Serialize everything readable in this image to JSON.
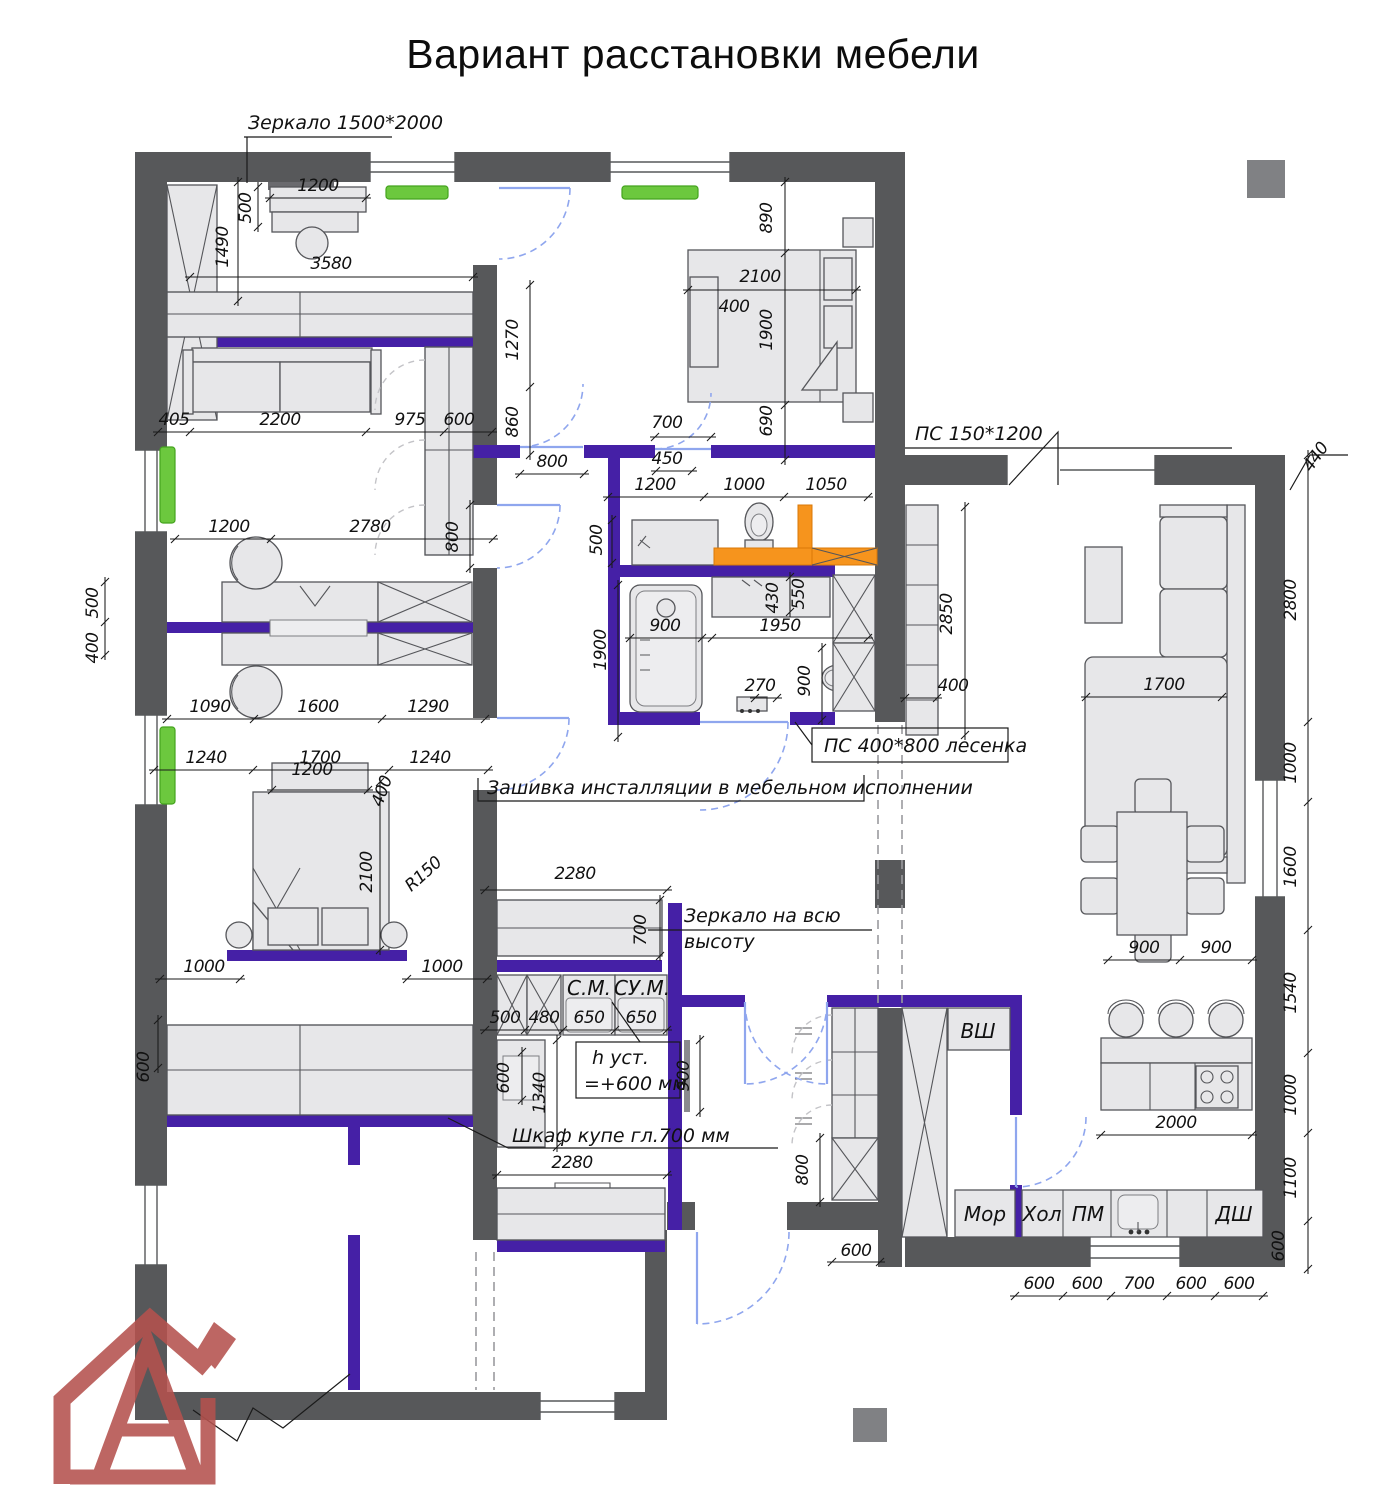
{
  "title": "Вариант расстановки мебели",
  "colors": {
    "wall_gray": "#57585a",
    "accent_purple": "#4520a6",
    "radiator_green": "#6cc83e",
    "installation_orange": "#f6941d",
    "door_blue": "#8fa6ee",
    "logo_red": "#b5524e"
  },
  "annotations": {
    "mirror_top": "Зеркало  1500*2000",
    "ps_window": "ПС  150*1200",
    "ps_ladder": "ПС  400*800  лесенка",
    "installation": "Зашивка инсталляции в мебельном исполнении",
    "mirror_full_1": "Зеркало на всю",
    "mirror_full_2": "высоту",
    "wardrobe": "Шкаф купе гл.700 мм",
    "h_inst_1": "h  уст.",
    "h_inst_2": "=+600 мм"
  },
  "labels": {
    "vsh": "ВШ",
    "mor": "Мор",
    "hol": "Хол",
    "pm": "ПМ",
    "dsh": "ДШ",
    "sm": "С.М.",
    "sum": "СУ.М."
  },
  "dims": [
    {
      "t": "1200",
      "x": 318,
      "y": 191
    },
    {
      "t": "500",
      "x": 251,
      "y": 208,
      "r": -90
    },
    {
      "t": "1490",
      "x": 228,
      "y": 247,
      "r": -90
    },
    {
      "t": "3580",
      "x": 331,
      "y": 269
    },
    {
      "t": "405",
      "x": 174,
      "y": 425
    },
    {
      "t": "2200",
      "x": 280,
      "y": 425
    },
    {
      "t": "975",
      "x": 410,
      "y": 425
    },
    {
      "t": "600",
      "x": 459,
      "y": 425
    },
    {
      "t": "1270",
      "x": 518,
      "y": 340,
      "r": -90
    },
    {
      "t": "860",
      "x": 518,
      "y": 422,
      "r": -90
    },
    {
      "t": "800",
      "x": 552,
      "y": 467
    },
    {
      "t": "890",
      "x": 772,
      "y": 218,
      "r": -90
    },
    {
      "t": "2100",
      "x": 760,
      "y": 282
    },
    {
      "t": "1900",
      "x": 772,
      "y": 330,
      "r": -90
    },
    {
      "t": "690",
      "x": 772,
      "y": 421,
      "r": -90
    },
    {
      "t": "400",
      "x": 734,
      "y": 312
    },
    {
      "t": "700",
      "x": 667,
      "y": 428
    },
    {
      "t": "450",
      "x": 667,
      "y": 464
    },
    {
      "t": "1200",
      "x": 655,
      "y": 490
    },
    {
      "t": "1000",
      "x": 744,
      "y": 490
    },
    {
      "t": "1050",
      "x": 826,
      "y": 490
    },
    {
      "t": "500",
      "x": 602,
      "y": 540,
      "r": -90
    },
    {
      "t": "900",
      "x": 665,
      "y": 631
    },
    {
      "t": "1900",
      "x": 606,
      "y": 650,
      "r": -90
    },
    {
      "t": "1950",
      "x": 780,
      "y": 631
    },
    {
      "t": "430",
      "x": 778,
      "y": 598,
      "r": -90
    },
    {
      "t": "550",
      "x": 804,
      "y": 594,
      "r": -90
    },
    {
      "t": "270",
      "x": 760,
      "y": 691
    },
    {
      "t": "900",
      "x": 810,
      "y": 681,
      "r": -90
    },
    {
      "t": "2850",
      "x": 952,
      "y": 614,
      "r": -90
    },
    {
      "t": "400",
      "x": 953,
      "y": 691
    },
    {
      "t": "440",
      "x": 1320,
      "y": 460,
      "r": -55
    },
    {
      "t": "2800",
      "x": 1296,
      "y": 600,
      "r": -90
    },
    {
      "t": "1000",
      "x": 1296,
      "y": 763,
      "r": -90
    },
    {
      "t": "1600",
      "x": 1296,
      "y": 867,
      "r": -90
    },
    {
      "t": "1540",
      "x": 1296,
      "y": 993,
      "r": -90
    },
    {
      "t": "1000",
      "x": 1296,
      "y": 1095,
      "r": -90
    },
    {
      "t": "1100",
      "x": 1296,
      "y": 1178,
      "r": -90
    },
    {
      "t": "600",
      "x": 1284,
      "y": 1246,
      "r": -90
    },
    {
      "t": "1700",
      "x": 1164,
      "y": 690
    },
    {
      "t": "900",
      "x": 1144,
      "y": 953
    },
    {
      "t": "900",
      "x": 1216,
      "y": 953
    },
    {
      "t": "2000",
      "x": 1176,
      "y": 1128
    },
    {
      "t": "600",
      "x": 1039,
      "y": 1289
    },
    {
      "t": "600",
      "x": 1087,
      "y": 1289
    },
    {
      "t": "700",
      "x": 1139,
      "y": 1289
    },
    {
      "t": "600",
      "x": 1191,
      "y": 1289
    },
    {
      "t": "600",
      "x": 1239,
      "y": 1289
    },
    {
      "t": "800",
      "x": 808,
      "y": 1170,
      "r": -90
    },
    {
      "t": "600",
      "x": 856,
      "y": 1256
    },
    {
      "t": "2280",
      "x": 575,
      "y": 879
    },
    {
      "t": "700",
      "x": 646,
      "y": 930,
      "r": -90
    },
    {
      "t": "500",
      "x": 505,
      "y": 1023
    },
    {
      "t": "480",
      "x": 544,
      "y": 1023
    },
    {
      "t": "650",
      "x": 589,
      "y": 1023
    },
    {
      "t": "650",
      "x": 641,
      "y": 1023
    },
    {
      "t": "1340",
      "x": 545,
      "y": 1093,
      "r": -90
    },
    {
      "t": "600",
      "x": 509,
      "y": 1078,
      "r": -90
    },
    {
      "t": "900",
      "x": 689,
      "y": 1076,
      "r": -90
    },
    {
      "t": "2280",
      "x": 572,
      "y": 1168
    },
    {
      "t": "1200",
      "x": 229,
      "y": 532
    },
    {
      "t": "2780",
      "x": 370,
      "y": 532
    },
    {
      "t": "800",
      "x": 458,
      "y": 537,
      "r": -90
    },
    {
      "t": "500",
      "x": 98,
      "y": 603,
      "r": -90
    },
    {
      "t": "400",
      "x": 98,
      "y": 648,
      "r": -90
    },
    {
      "t": "1090",
      "x": 210,
      "y": 712
    },
    {
      "t": "1600",
      "x": 318,
      "y": 712
    },
    {
      "t": "1290",
      "x": 428,
      "y": 712
    },
    {
      "t": "1200",
      "x": 312,
      "y": 775
    },
    {
      "t": "400",
      "x": 387,
      "y": 793,
      "r": -70
    },
    {
      "t": "1240",
      "x": 206,
      "y": 763
    },
    {
      "t": "1700",
      "x": 320,
      "y": 763
    },
    {
      "t": "1240",
      "x": 430,
      "y": 763
    },
    {
      "t": "2100",
      "x": 372,
      "y": 872,
      "r": -90
    },
    {
      "t": "R150",
      "x": 427,
      "y": 878,
      "r": -42
    },
    {
      "t": "1000",
      "x": 204,
      "y": 972
    },
    {
      "t": "1000",
      "x": 442,
      "y": 972
    },
    {
      "t": "600",
      "x": 149,
      "y": 1067,
      "r": -90
    }
  ]
}
